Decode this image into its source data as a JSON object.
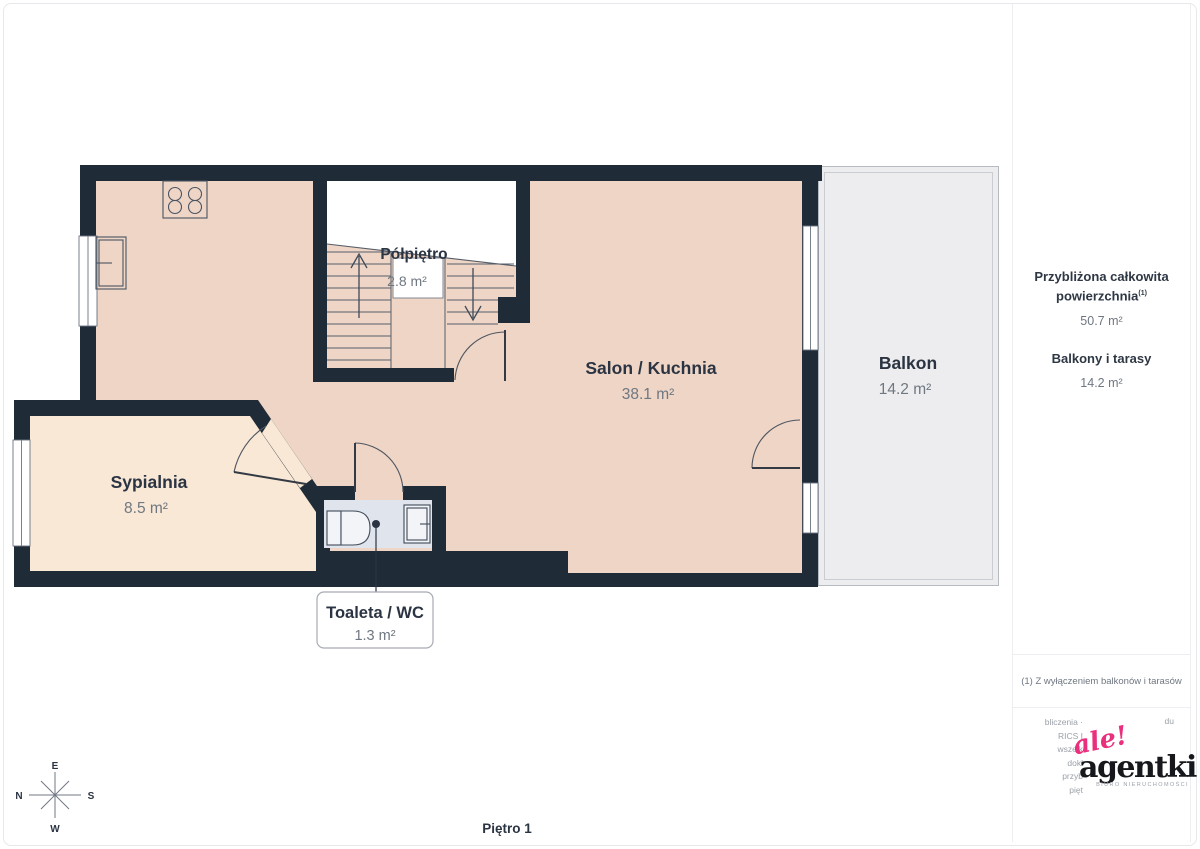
{
  "page": {
    "floor_label": "Piętro 1"
  },
  "plan": {
    "rooms": [
      {
        "name": "Półpiętro",
        "area": "2.8 m²"
      },
      {
        "name": "Salon / Kuchnia",
        "area": "38.1 m²"
      },
      {
        "name": "Balkon",
        "area": "14.2 m²"
      },
      {
        "name": "Sypialnia",
        "area": "8.5 m²"
      },
      {
        "name": "Toaleta / WC",
        "area": "1.3 m²"
      }
    ],
    "compass": {
      "top": "E",
      "right": "S",
      "bottom": "W",
      "left": "N"
    }
  },
  "sidebar": {
    "total_label": "Przybliżona całkowita powierzchnia",
    "total_marker": "(1)",
    "total_value": "50.7 m²",
    "balconies_label": "Balkony i tarasy",
    "balconies_value": "14.2 m²",
    "footnote": "(1) Z wyłączeniem balkonów i tarasów",
    "disclaimer_fragments": [
      "bliczenia ·",
      "RICS I",
      "wszelk",
      "dokł",
      "przyb",
      "pięt"
    ],
    "disclaimer_fragment_right": "du",
    "brand": {
      "script": "ale!",
      "name": "agentki",
      "tagline": "BIURO NIERUCHOMOŚCI"
    }
  },
  "colors": {
    "wall": "#202b38",
    "salon_fill": "#eed5c6",
    "bedroom_fill": "#f9e8d6",
    "toilet_fill": "#dfe4ed",
    "balcony_fill": "#ededef",
    "accent_pink": "#ea2f7d",
    "label_dark": "#2b3442",
    "label_gray": "#6f7781"
  }
}
